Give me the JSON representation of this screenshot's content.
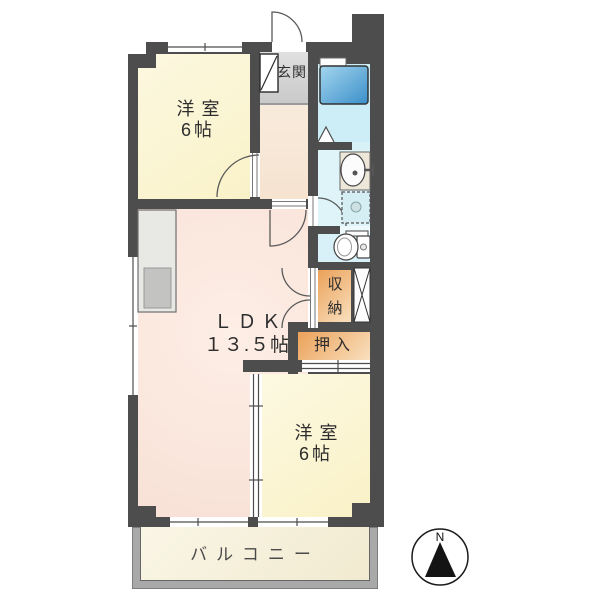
{
  "compass": {
    "label": "N"
  },
  "rooms": {
    "bedroom_top": {
      "name": "洋室",
      "size": "6帖"
    },
    "entrance": {
      "name": "玄関"
    },
    "ldk": {
      "name": "ＬＤＫ",
      "size": "１３.５帖"
    },
    "storage": {
      "name": "収納"
    },
    "closet": {
      "name": "押入"
    },
    "bedroom_bottom": {
      "name": "洋室",
      "size": "6帖"
    },
    "balcony": {
      "name": "バルコニー"
    }
  },
  "fixture_icons": [
    "bathtub-icon",
    "washbasin-icon",
    "washing-machine-icon",
    "toilet-icon",
    "kitchen-counter-icon",
    "shoe-cabinet-icon",
    "pipe-space-icon",
    "door-swing-icon",
    "sliding-door-icon",
    "window-icon",
    "compass-icon"
  ],
  "colors": {
    "wall": "#4d4d4d",
    "bedroom": "#fbf5d6",
    "ldk": "#f9e4da",
    "hallway": "#f7e7d7",
    "entrance_floor": "#d6d6d6",
    "bathroom": "#cdeef6",
    "washroom": "#def4f8",
    "storage": "#eda55c",
    "storage_light": "#f9e0bf",
    "balcony_floor": "#f5efd7",
    "balcony_frame": "#a9a9a9",
    "bathtub": "#3b8fc9"
  }
}
